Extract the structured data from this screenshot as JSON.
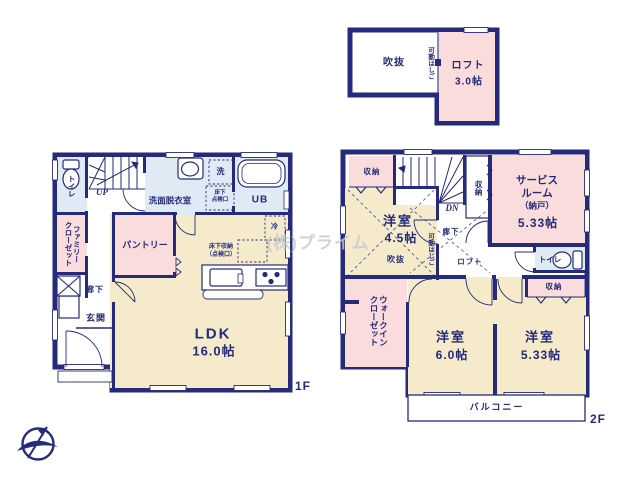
{
  "colors": {
    "wall": "#252a7a",
    "text": "#252a7a",
    "cream": "#f5ebca",
    "pink": "#fadcdc",
    "blue": "#dfeaf4",
    "watermark": "#c7c7d0"
  },
  "watermark": "(株)プライム",
  "loft_plan": {
    "void": "吹抜",
    "ladder": "可動はしご",
    "loft": "ロフト",
    "loft_size": "3.0帖"
  },
  "floor1": {
    "label": "1F",
    "toilet": "トイレ",
    "stairs_up": "UP",
    "washroom": "洗面脱衣室",
    "washer": "洗",
    "underfloor_hatch_l1": "床下",
    "underfloor_hatch_l2": "点検口",
    "unit_bath": "UB",
    "family_closet_l1": "ファミリー",
    "family_closet_l2": "クローゼット",
    "pantry": "パントリー",
    "hallway": "廊下",
    "entrance": "玄関",
    "ldk": "LDK",
    "ldk_size": "16.0帖",
    "underfloor_storage_l1": "床下収納",
    "underfloor_storage_l2": "（点検口）",
    "fridge": "冷"
  },
  "floor2": {
    "label": "2F",
    "storage_tl": "収納",
    "stairs_dn": "DN",
    "room_45_label": "洋室",
    "room_45_size": "4.5帖",
    "void": "吹抜",
    "ladder": "可動はしご",
    "storage_mid": "収納",
    "service_room_l1": "サービス",
    "service_room_l2": "ルーム",
    "service_room_l3": "（納戸）",
    "service_room_size": "5.33帖",
    "hallway": "廊下",
    "loft": "ロフト",
    "toilet": "トイレ",
    "walk_in_closet_l1": "ウォークイン",
    "walk_in_closet_l2": "クローゼット",
    "room_60_label": "洋室",
    "room_60_size": "6.0帖",
    "storage_r": "収納",
    "room_533_label": "洋室",
    "room_533_size": "5.33帖",
    "balcony": "バルコニー"
  }
}
